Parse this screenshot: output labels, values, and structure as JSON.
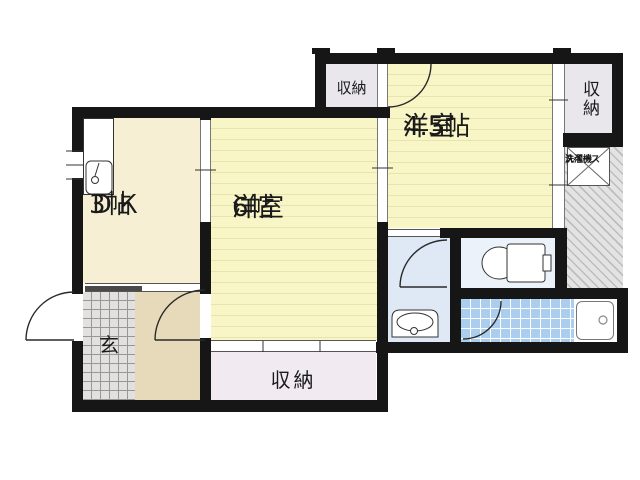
{
  "plan": {
    "type": "apartment-floor-plan",
    "rooms": {
      "dk": {
        "name": "ＤＫ",
        "size": "3帖"
      },
      "western_6": {
        "name": "洋室",
        "size": "6帖"
      },
      "western_4_5": {
        "name": "洋室",
        "size": "4.5帖"
      },
      "closet_top_left": {
        "name": "収納"
      },
      "closet_top_right": {
        "name": "収納"
      },
      "closet_bottom": {
        "name": "収納"
      },
      "entrance": {
        "name": "玄"
      },
      "laundry": {
        "line1": "洗濯機",
        "line2": "スペース"
      }
    },
    "colors": {
      "wall": "#161616",
      "tatami_room": "#f8f5c6",
      "tatami_stripe": "#e9e4ae",
      "dk_floor": "#f6efd3",
      "hall_floor": "#e7daba",
      "closet_gray": "#e9e7ec",
      "closet_pink": "#f1eaf1",
      "washroom_floor": "#dfe9f5",
      "toilet_floor": "#ecf2fa",
      "bath_tile": "#abcdee",
      "genkan_tile": "#e2e1df",
      "hatch_bg": "#e3e3e3",
      "hatch_line": "#bdbdbd"
    }
  }
}
